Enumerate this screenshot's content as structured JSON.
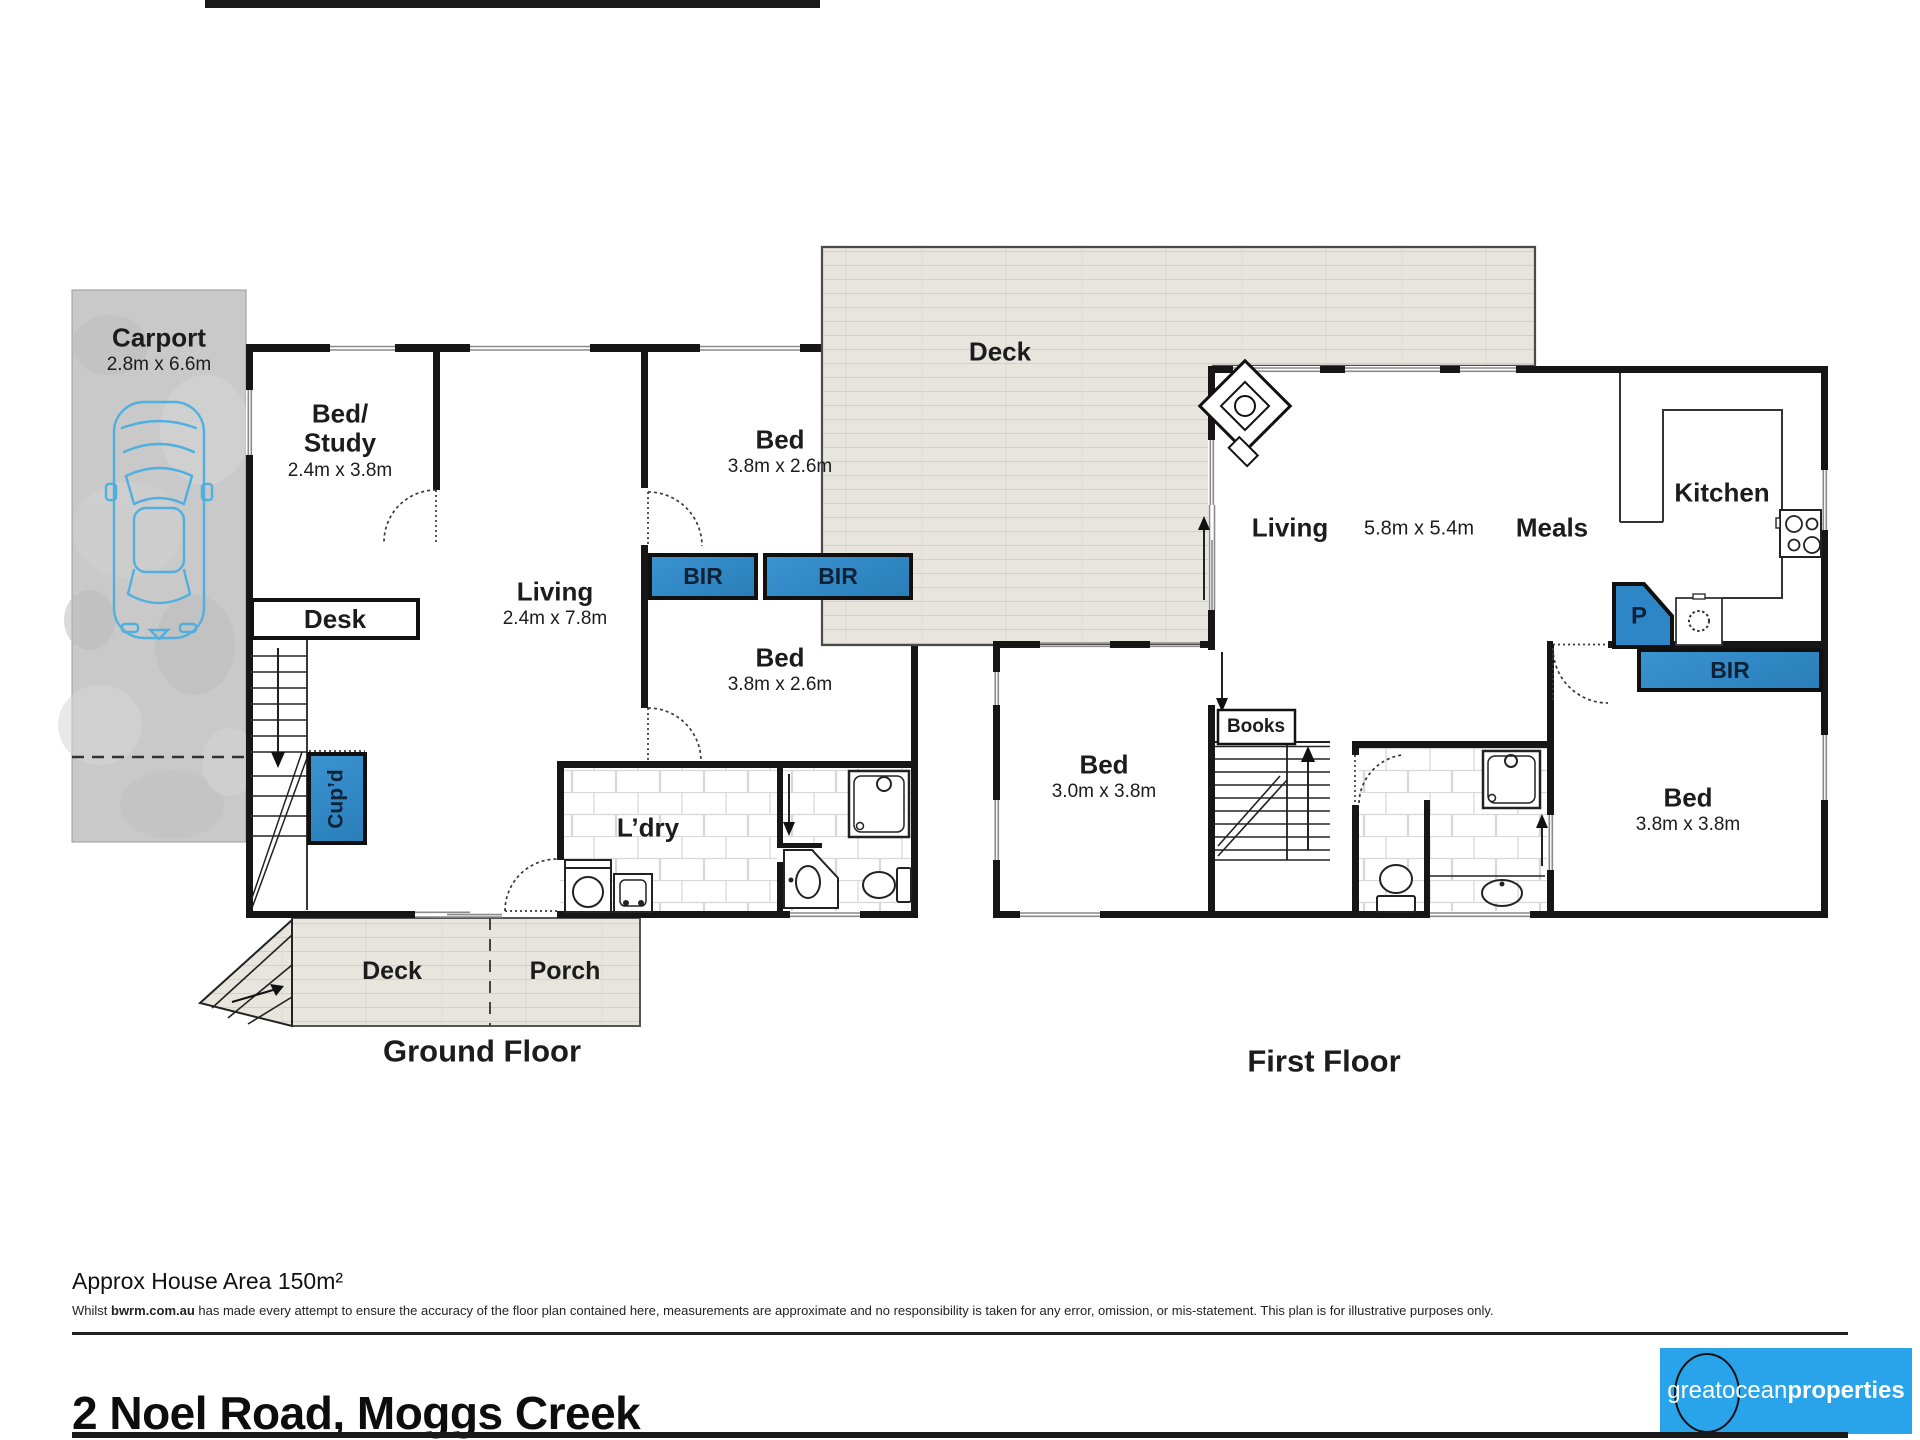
{
  "colors": {
    "feature_blue": "#2E86C6",
    "logo_blue": "#29A4EA"
  },
  "ground_floor": {
    "caption": "Ground Floor",
    "carport": {
      "name": "Carport",
      "dims": "2.8m x 6.6m"
    },
    "bed_study": {
      "line1": "Bed/",
      "line2": "Study",
      "dims": "2.4m x 3.8m"
    },
    "desk": "Desk",
    "living": {
      "name": "Living",
      "dims": "2.4m x 7.8m"
    },
    "bed_top": {
      "name": "Bed",
      "dims": "3.8m x 2.6m"
    },
    "bir_left": "BIR",
    "bir_right": "BIR",
    "bed_mid": {
      "name": "Bed",
      "dims": "3.8m x 2.6m"
    },
    "cupboard": "Cup’d",
    "laundry": "L’dry",
    "deck": "Deck",
    "porch": "Porch"
  },
  "first_floor": {
    "caption": "First Floor",
    "deck": "Deck",
    "living": {
      "name": "Living",
      "dims": "5.8m x 5.4m"
    },
    "meals": "Meals",
    "kitchen": "Kitchen",
    "bed_left": {
      "name": "Bed",
      "dims": "3.0m x 3.8m"
    },
    "books": "Books",
    "pantry": "P",
    "bir": "BIR",
    "bed_right": {
      "name": "Bed",
      "dims": "3.8m x 3.8m"
    }
  },
  "footer": {
    "area_note": "Approx House Area 150m²",
    "disclaimer": {
      "prefix": "Whilst ",
      "brand": "bwrm.com.au",
      "rest": " has made every attempt to ensure the accuracy of the floor plan contained here, measurements are approximate and no responsibility is taken for any error, omission, or mis-statement. This plan is for illustrative purposes only."
    },
    "address": "2 Noel Road, Moggs Creek",
    "logo": {
      "part1": "great",
      "part2": "ocean",
      "part3": "properties"
    }
  }
}
